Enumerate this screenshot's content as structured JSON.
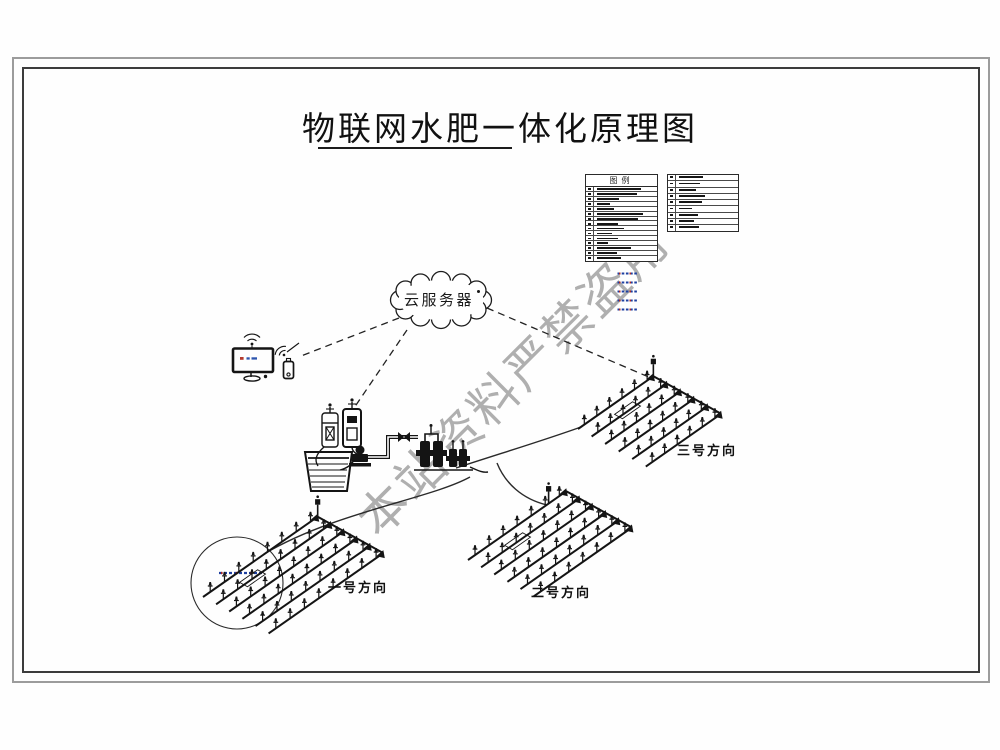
{
  "title": "物联网水肥一体化原理图",
  "watermark": "本站资料严禁盗用",
  "cloud": {
    "label": "云服务器"
  },
  "legend": {
    "header": "图例",
    "left_row_bars": [
      44,
      40,
      22,
      13,
      17,
      46,
      41,
      21,
      27,
      15,
      21,
      11,
      34,
      20,
      24
    ],
    "right_row_bars": [
      24,
      21,
      17,
      26,
      23,
      13,
      19,
      15,
      20
    ],
    "dash_samples": 5
  },
  "fields": [
    {
      "label": "一号方向"
    },
    {
      "label": "二号方向"
    },
    {
      "label": "三号方向"
    }
  ],
  "colors": {
    "ink": "#141414",
    "watermark_gray": "#a2a2a2",
    "frame_outer": "#9c9c9c",
    "frame_inner": "#3c3c3c",
    "accent_blue": "#1d3fa0",
    "accent_red": "#a82626"
  }
}
